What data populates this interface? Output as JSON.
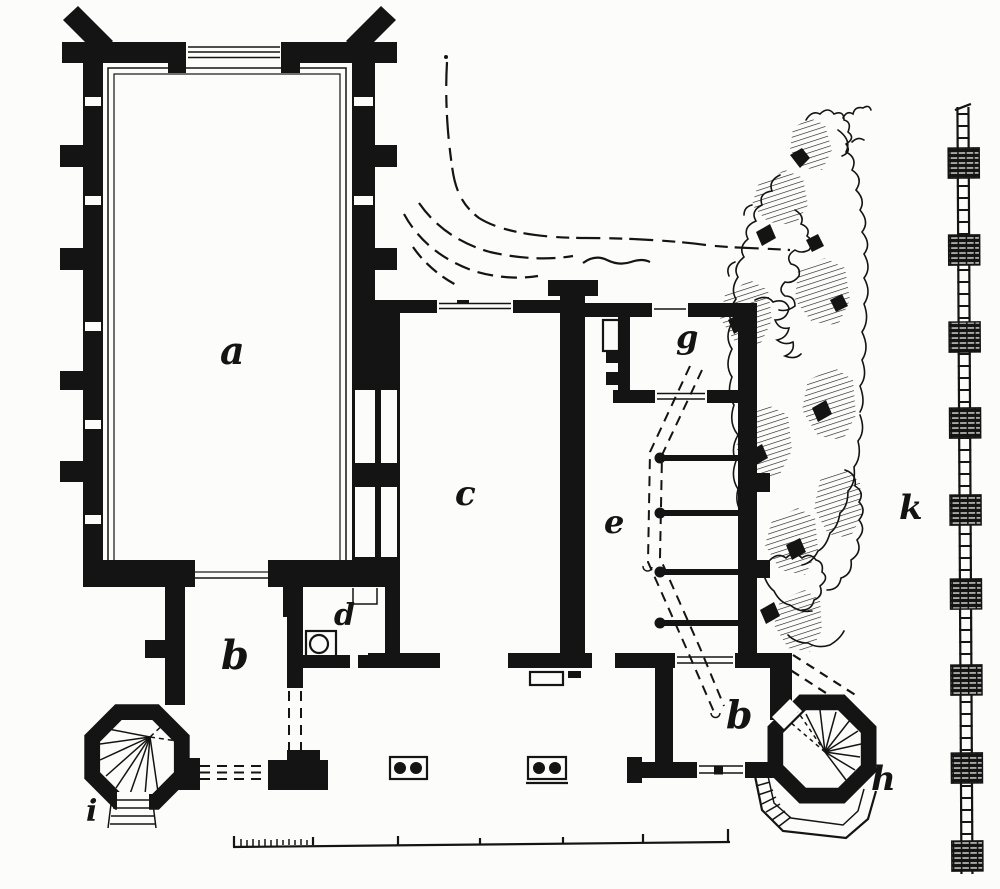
{
  "figure": {
    "kind": "engraved ground plan of a medieval hall complex with stair turrets",
    "colors": {
      "ink": "#141414",
      "paper": "#fcfcfa"
    }
  },
  "labels": {
    "hall": "a",
    "passage": "b",
    "room_c": "c",
    "font_d": "d",
    "stair_e": "e",
    "room_g": "g",
    "room_b2": "b",
    "tower_h": "h",
    "tower_i": "i",
    "wall_k": "k"
  },
  "scale_bar": {
    "major_divisions": 6,
    "subdivided_first_division_ticks": 12
  }
}
